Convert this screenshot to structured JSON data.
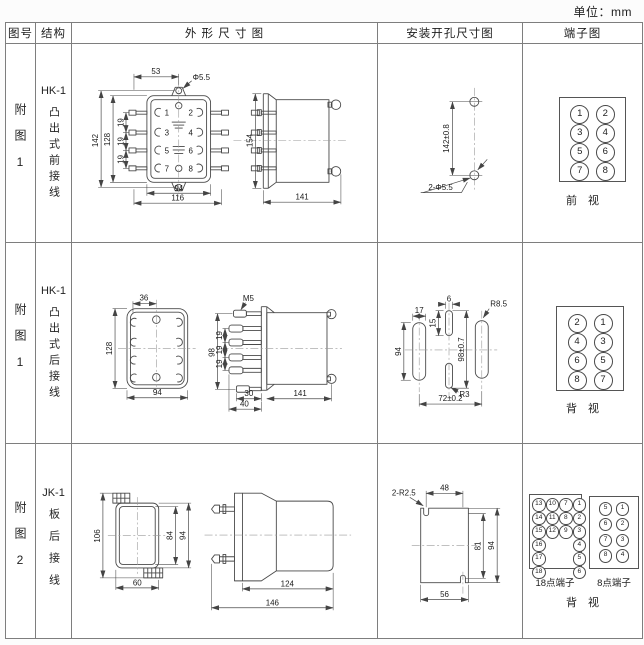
{
  "unit_label": "单位：mm",
  "header": {
    "fig_no": "图号",
    "structure": "结构",
    "outline": "外 形 尺 寸 图",
    "install": "安装开孔尺寸图",
    "terminal": "端子图"
  },
  "rows": [
    {
      "fig_no": "附图1",
      "model": "HK-1",
      "structure": "凸出式前接线",
      "outline": {
        "front": {
          "d53": "53",
          "hole": "Φ5.5",
          "d142": "142",
          "d128": "128",
          "p1": "19",
          "p2": "19",
          "p3": "19",
          "d94": "94",
          "d116": "116",
          "n1": "1",
          "n2": "2",
          "n3": "3",
          "n4": "4",
          "n5": "5",
          "n6": "6",
          "n7": "7",
          "n8": "8"
        },
        "side": {
          "d154": "154",
          "d141": "141"
        }
      },
      "install": {
        "pitch": "142±0.8",
        "holes": "2-Φ5.5"
      },
      "terminal": {
        "grid": [
          [
            "1",
            "2"
          ],
          [
            "3",
            "4"
          ],
          [
            "5",
            "6"
          ],
          [
            "7",
            "8"
          ]
        ],
        "view": "前　视"
      }
    },
    {
      "fig_no": "附图1",
      "model": "HK-1",
      "structure": "凸出式后接线",
      "outline": {
        "front": {
          "d36": "36",
          "d128": "128",
          "d94": "94"
        },
        "side": {
          "m5": "M5",
          "d98": "98",
          "p1": "19",
          "p2": "19",
          "p3": "19",
          "d30": "30",
          "d40": "40",
          "d141": "141"
        }
      },
      "install": {
        "d17": "17",
        "d6": "6",
        "d15": "15",
        "d94": "94",
        "d98": "98±0.7",
        "r85": "R8.5",
        "r3": "R3",
        "d72": "72±0.2"
      },
      "terminal": {
        "grid": [
          [
            "2",
            "1"
          ],
          [
            "4",
            "3"
          ],
          [
            "6",
            "5"
          ],
          [
            "8",
            "7"
          ]
        ],
        "view": "背　视"
      }
    },
    {
      "fig_no": "附图2",
      "model": "JK-1",
      "structure": "板后接线",
      "outline": {
        "front": {
          "d106": "106",
          "d84": "84",
          "d94": "94",
          "d60": "60"
        },
        "side": {
          "d124": "124",
          "d146": "146"
        }
      },
      "install": {
        "r25": "2-R2.5",
        "d48": "48",
        "d81": "81",
        "d94": "94",
        "d56": "56"
      },
      "terminal": {
        "t18_label": "18点端子",
        "t8_label": "8点端子",
        "view": "背　视",
        "t18": [
          [
            "13",
            "10",
            "7",
            "1"
          ],
          [
            "14",
            "11",
            "8",
            "2"
          ],
          [
            "15",
            "12",
            "9",
            "3"
          ],
          [
            "16",
            "",
            "",
            "4"
          ],
          [
            "17",
            "",
            "",
            "5"
          ],
          [
            "18",
            "",
            "",
            "6"
          ]
        ],
        "t8": [
          [
            "5",
            "1"
          ],
          [
            "6",
            "2"
          ],
          [
            "7",
            "3"
          ],
          [
            "8",
            "4"
          ]
        ]
      }
    }
  ]
}
